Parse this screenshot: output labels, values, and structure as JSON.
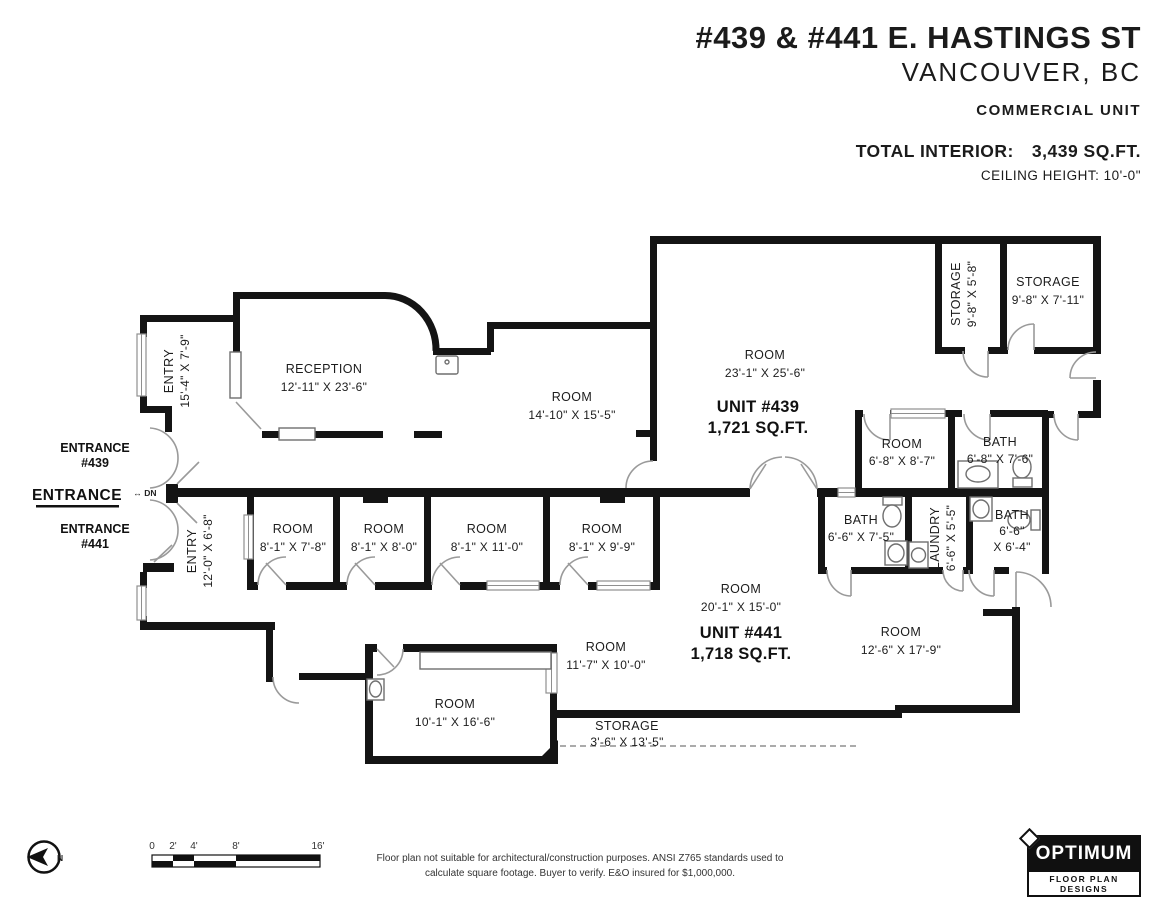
{
  "header": {
    "title": "#439 & #441 E. HASTINGS ST",
    "subtitle": "VANCOUVER, BC",
    "unit_type": "COMMERCIAL UNIT",
    "total_label": "TOTAL INTERIOR:",
    "total_value": "3,439 SQ.FT.",
    "ceiling": "CEILING HEIGHT: 10'-0\""
  },
  "plan": {
    "entry439": {
      "name": "ENTRY",
      "dims": "15'-4\" X 7'-9\""
    },
    "reception": {
      "name": "RECEPTION",
      "dims": "12'-11\" X 23'-6\""
    },
    "room_mid": {
      "name": "ROOM",
      "dims": "14'-10\" X 15'-5\""
    },
    "room_439": {
      "name": "ROOM",
      "dims": "23'-1\" X 25'-6\""
    },
    "unit439": {
      "name": "UNIT #439",
      "area": "1,721 SQ.FT."
    },
    "storage_a": {
      "name": "STORAGE",
      "dims": "9'-8\" X 5'-8\""
    },
    "storage_b": {
      "name": "STORAGE",
      "dims": "9'-8\" X 7'-11\""
    },
    "room_68": {
      "name": "ROOM",
      "dims": "6'-8\" X 8'-7\""
    },
    "bath_439": {
      "name": "BATH",
      "dims": "6'-8\" X 7'-6\""
    },
    "entry441": {
      "name": "ENTRY",
      "dims": "12'-0\" X 6'-8\""
    },
    "room_a": {
      "name": "ROOM",
      "dims": "8'-1\" X 7'-8\""
    },
    "room_b": {
      "name": "ROOM",
      "dims": "8'-1\" X 8'-0\""
    },
    "room_c": {
      "name": "ROOM",
      "dims": "8'-1\" X 11'-0\""
    },
    "room_d": {
      "name": "ROOM",
      "dims": "8'-1\" X 9'-9\""
    },
    "bath_l": {
      "name": "BATH",
      "dims": "6'-6\" X 7'-5\""
    },
    "laundry": {
      "name": "LAUNDRY",
      "dims": "6'-6\" X 5'-5\""
    },
    "bath_r": {
      "name": "BATH",
      "dims_l1": "6'-6\"",
      "dims_l2": "X 6'-4\""
    },
    "room_441": {
      "name": "ROOM",
      "dims": "20'-1\" X 15'-0\""
    },
    "unit441": {
      "name": "UNIT #441",
      "area": "1,718 SQ.FT."
    },
    "room_126": {
      "name": "ROOM",
      "dims": "12'-6\" X 17'-9\""
    },
    "room_117": {
      "name": "ROOM",
      "dims": "11'-7\" X 10'-0\""
    },
    "room_101": {
      "name": "ROOM",
      "dims": "10'-1\" X 16'-6\""
    },
    "storage_c": {
      "name": "STORAGE",
      "dims": "3'-6\" X 13'-5\""
    }
  },
  "entrances": {
    "e439_l1": "ENTRANCE",
    "e439_l2": "#439",
    "main": "ENTRANCE",
    "dn": "↔ DN",
    "e441_l1": "ENTRANCE",
    "e441_l2": "#441"
  },
  "compass": {
    "north": "N"
  },
  "scale_bar": {
    "ticks": [
      "0",
      "2'",
      "4'",
      "8'",
      "16'"
    ]
  },
  "footer": {
    "disclaimer_line1": "Floor plan not suitable for architectural/construction purposes. ANSI Z765 standards used to",
    "disclaimer_line2": "calculate square footage. Buyer to verify.  E&O insured for $1,000,000."
  },
  "logo": {
    "name": "OPTIMUM",
    "tagline": "FLOOR PLAN DESIGNS"
  }
}
